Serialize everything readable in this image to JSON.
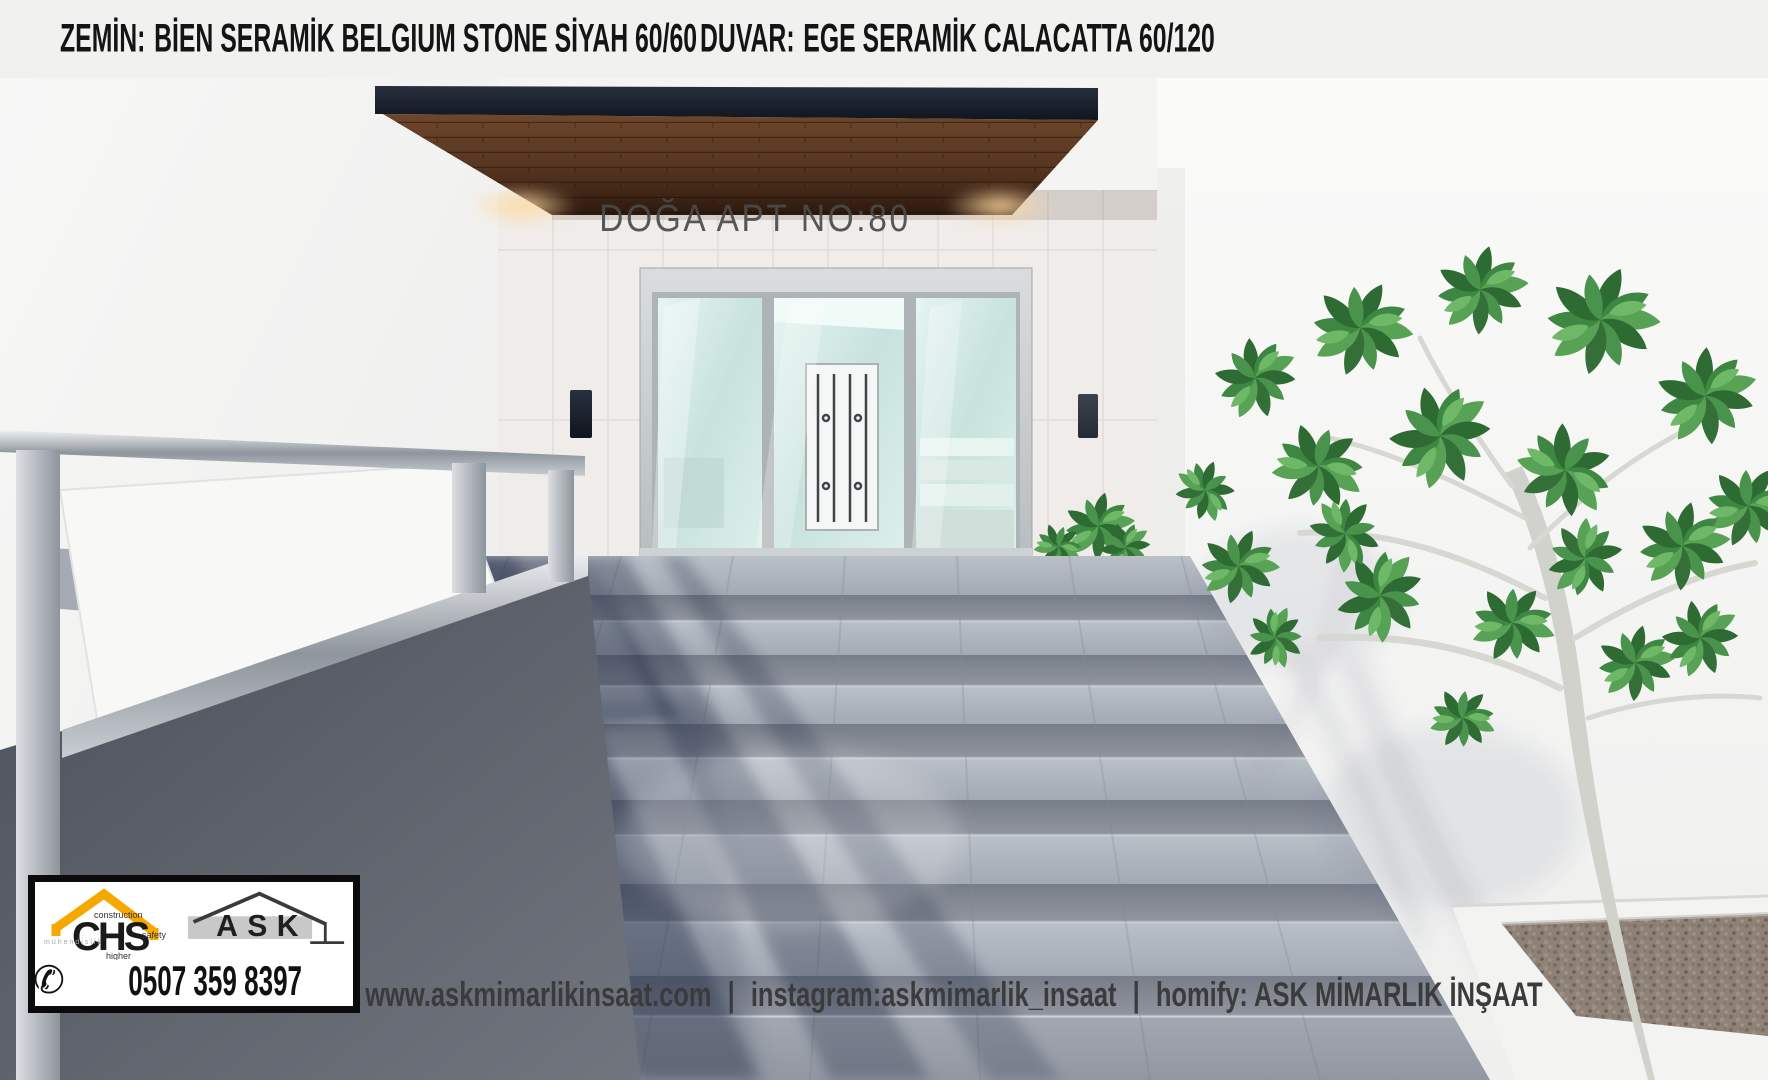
{
  "header": {
    "materials": [
      {
        "label": "ZEMİN:",
        "value": "BİEN SERAMİK BELGIUM STONE SİYAH 60/60"
      },
      {
        "label": "DUVAR:",
        "value": "EGE SERAMİK CALACATTA 60/120"
      }
    ]
  },
  "scene": {
    "building_sign": "DOĞA APT NO:80"
  },
  "branding": {
    "chs_logo": {
      "letters": "CHS",
      "word_construction": "construction",
      "word_safety": "safety",
      "word_higher": "higher",
      "word_left": "mühendislik"
    },
    "ask_logo": {
      "letters": "ASK"
    },
    "phone": "0507 359 8397",
    "icons": {
      "phone_icon": "✆"
    }
  },
  "contact_bar": {
    "website": "www.askmimarlikinsaat.com",
    "separator": "|",
    "instagram": "instagram:askmimarlik_insaat",
    "homify": "homify: ASK MİMARLIK İNŞAAT"
  },
  "colors": {
    "header_bg": "#F1F1F0",
    "accent_orange": "#F5A800",
    "wood_brown": "#6A422A",
    "fascia_navy": "#1C2430",
    "glass_mint": "#D7EDE8",
    "concrete_gray": "#9AA0AA",
    "leaf_green": "#3E8743",
    "text_dark": "#141414",
    "contact_text": "#3B3B3B"
  }
}
